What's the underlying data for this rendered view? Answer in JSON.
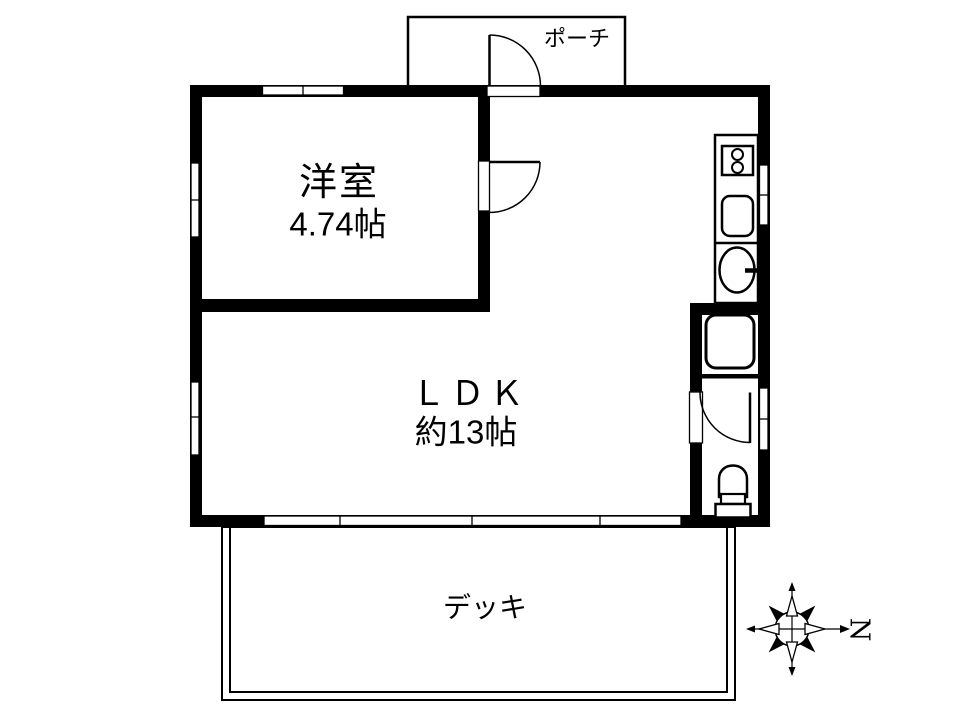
{
  "colors": {
    "line": "#000000",
    "wall": "#000000",
    "background": "#ffffff"
  },
  "rooms": {
    "porch": {
      "label": "ポーチ"
    },
    "western_room": {
      "label": "洋室",
      "size": "4.74帖"
    },
    "ldk": {
      "label": "ＬＤＫ",
      "size": "約13帖"
    },
    "deck": {
      "label": "デッキ"
    }
  },
  "compass": {
    "north_label": "N"
  },
  "fixtures": [
    {
      "name": "two-burner-stove-icon",
      "location": "kitchen"
    },
    {
      "name": "kitchen-sink-icon",
      "location": "kitchen"
    },
    {
      "name": "wash-basin-icon",
      "location": "kitchen-counter"
    },
    {
      "name": "bathtub-icon",
      "location": "bathroom"
    },
    {
      "name": "toilet-icon",
      "location": "toilet-room"
    },
    {
      "name": "door-swing-icon",
      "location": "entrance"
    },
    {
      "name": "door-swing-icon",
      "location": "western-room"
    },
    {
      "name": "door-swing-icon",
      "location": "washroom"
    }
  ]
}
